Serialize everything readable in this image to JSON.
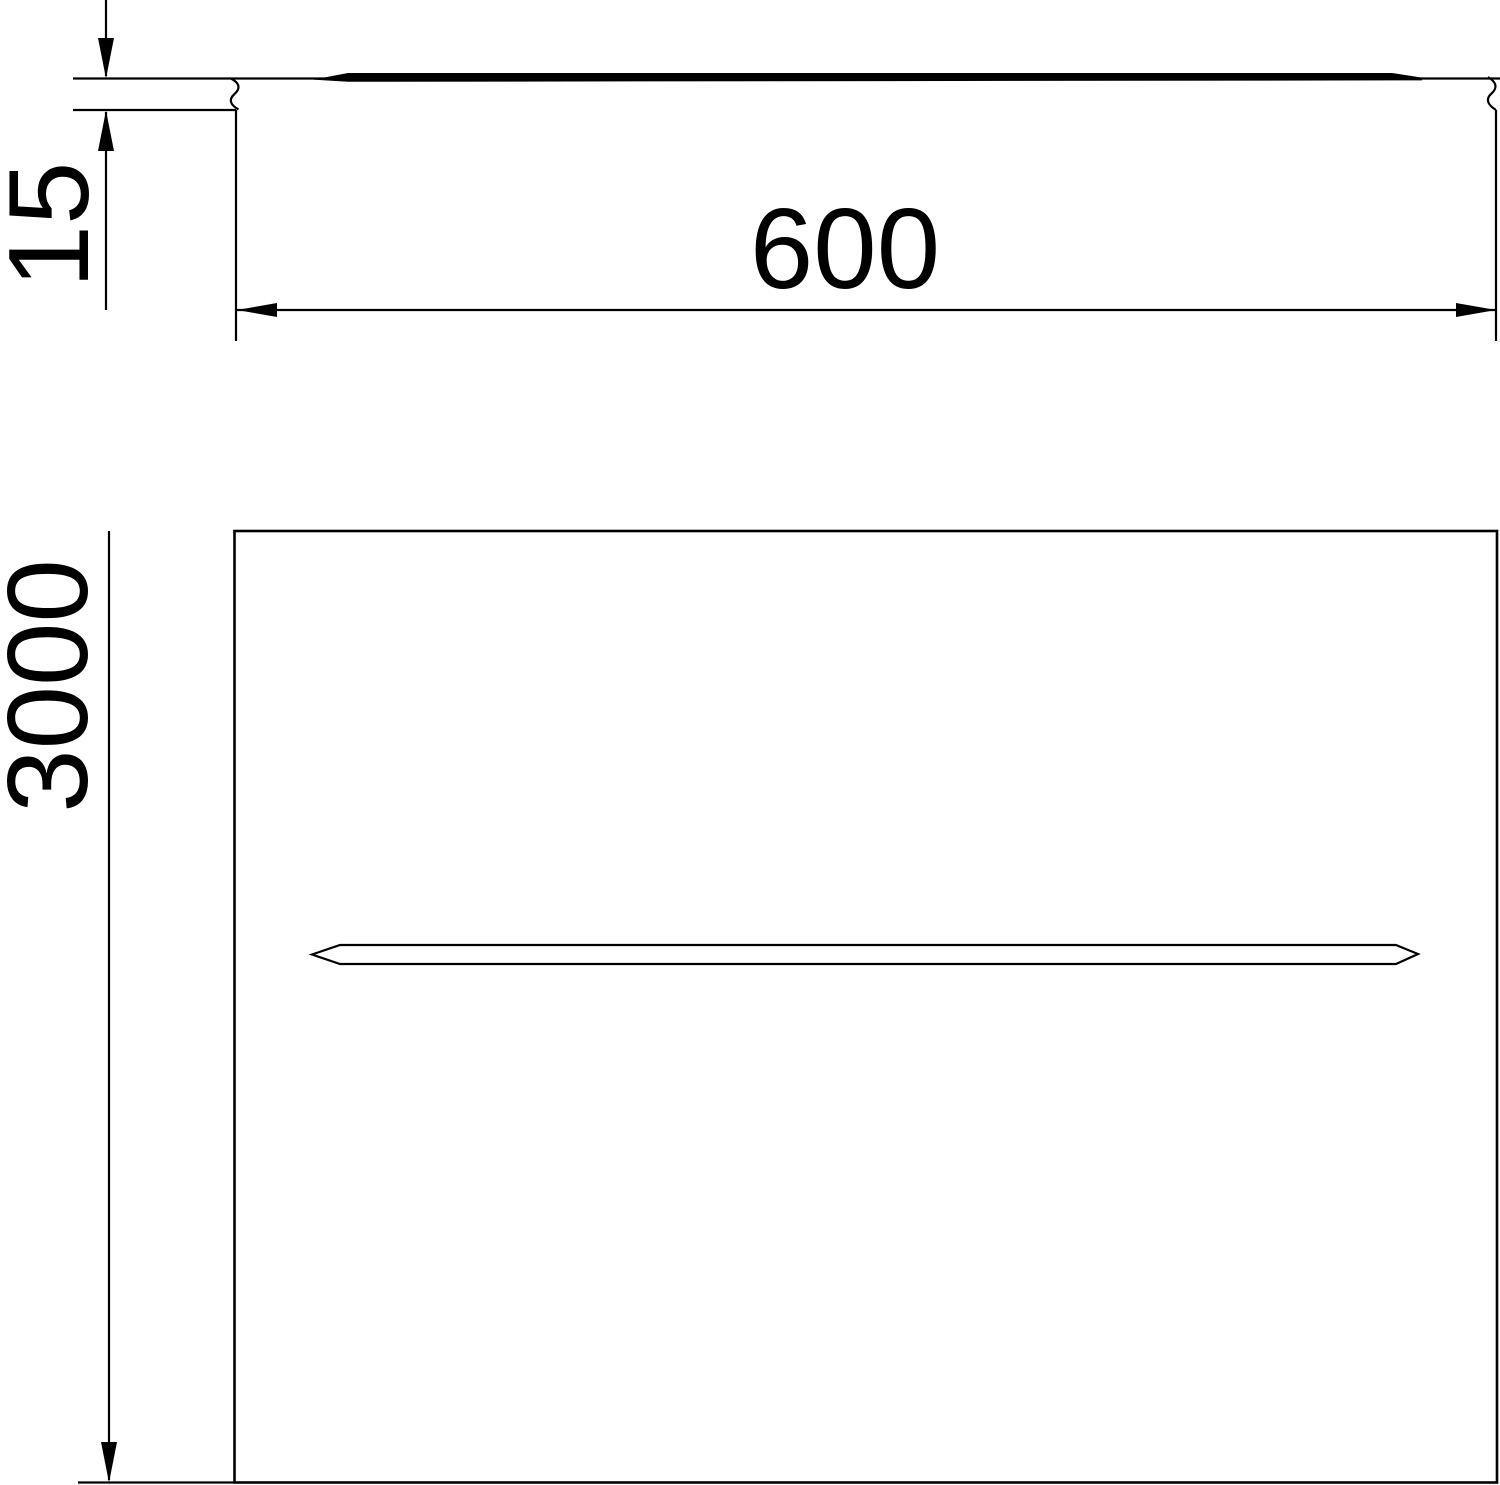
{
  "drawing": {
    "kind": "dimensioned technical drawing of a flat cover (side profile and plan view)",
    "background_color": "#ffffff",
    "stroke_color": "#000000",
    "labels": {
      "profile_height": "15",
      "width": "600",
      "length": "3000"
    }
  }
}
